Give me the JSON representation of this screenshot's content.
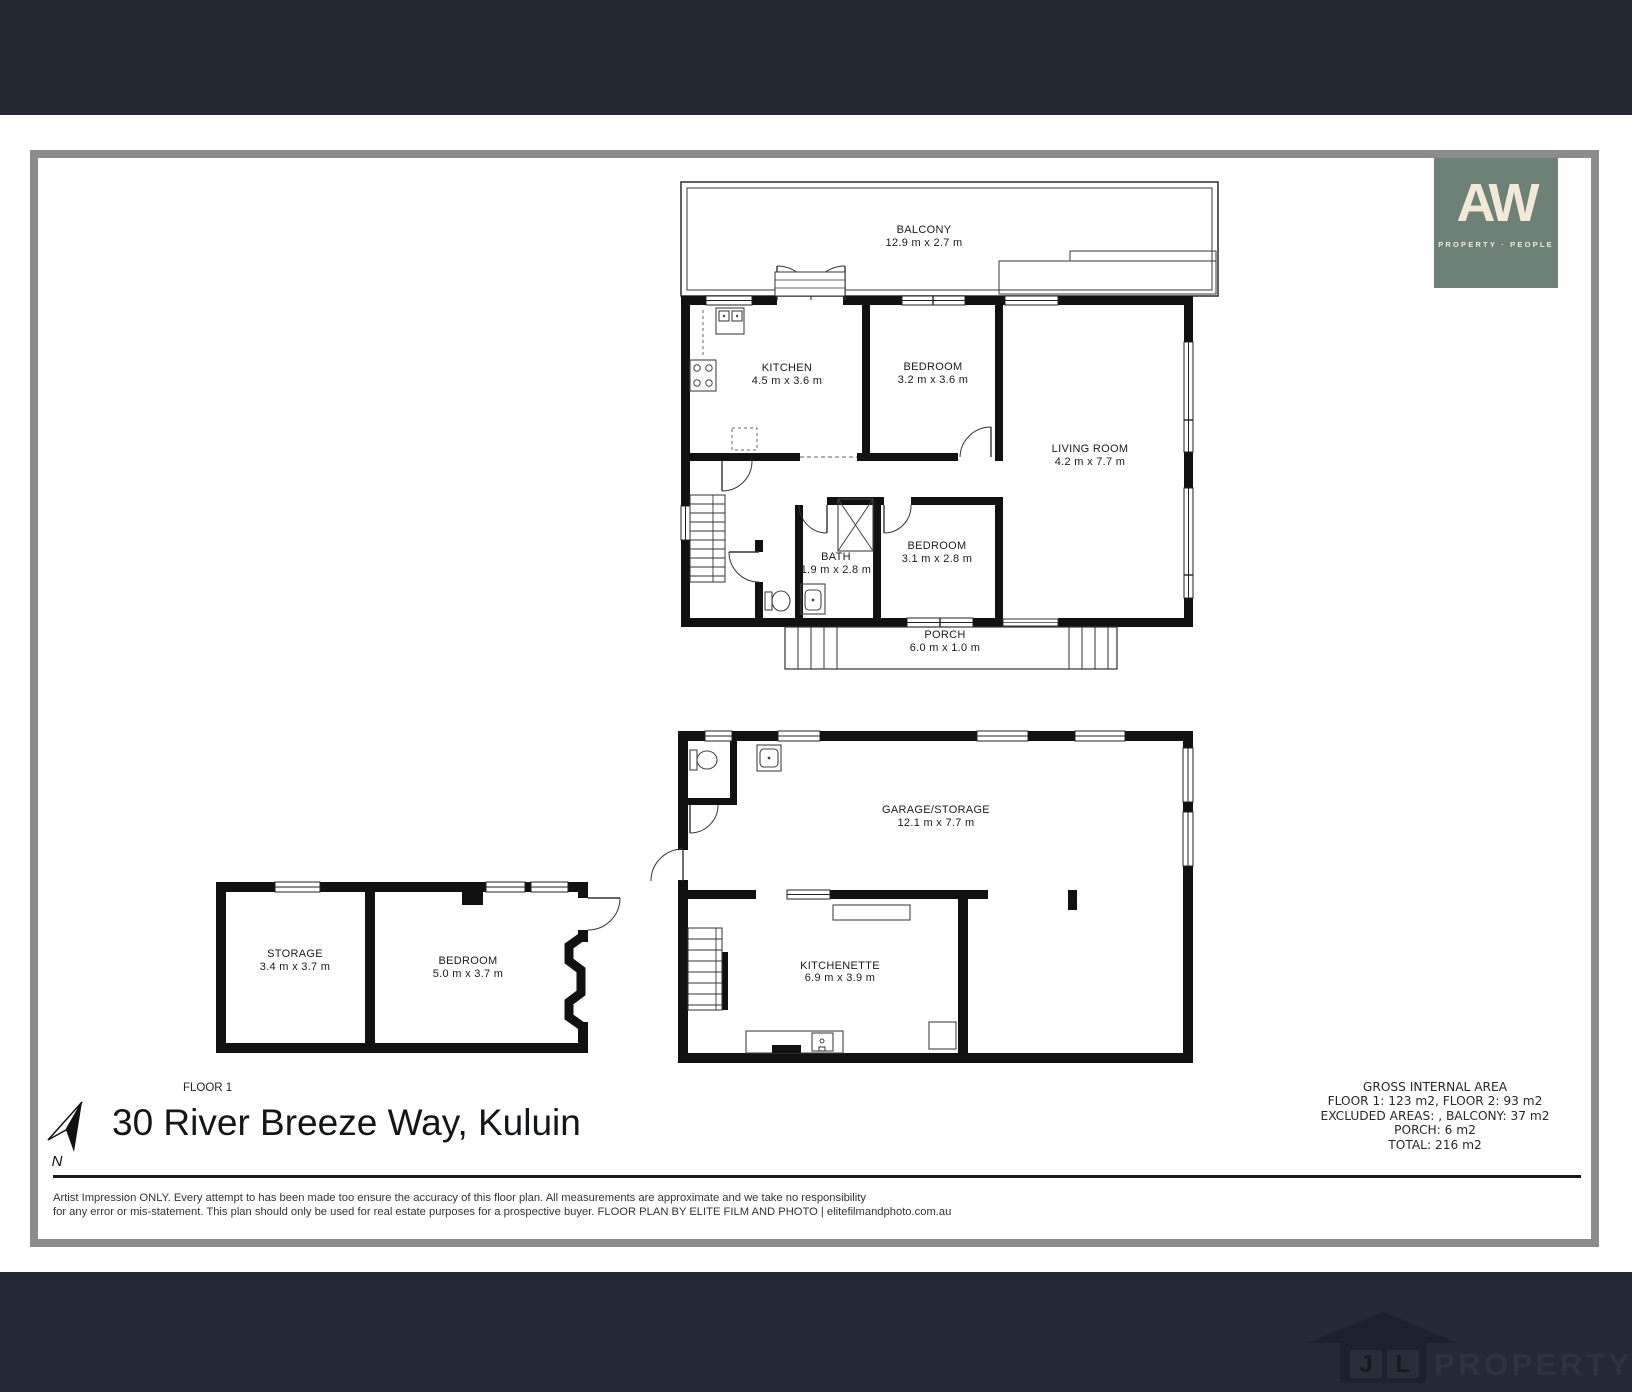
{
  "brand": {
    "monogram": "AW",
    "tagline": "PROPERTY · PEOPLE"
  },
  "floor2": {
    "balcony": {
      "name": "BALCONY",
      "dims": "12.9 m x 2.7 m"
    },
    "kitchen": {
      "name": "KITCHEN",
      "dims": "4.5 m x 3.6 m"
    },
    "bedroom1": {
      "name": "BEDROOM",
      "dims": "3.2 m x 3.6 m"
    },
    "living_room": {
      "name": "LIVING ROOM",
      "dims": "4.2 m x 7.7 m"
    },
    "bath": {
      "name": "BATH",
      "dims": "1.9 m x 2.8 m"
    },
    "bedroom2": {
      "name": "BEDROOM",
      "dims": "3.1 m x 2.8 m"
    },
    "porch": {
      "name": "PORCH",
      "dims": "6.0 m x 1.0 m"
    }
  },
  "floor1": {
    "label": "FLOOR 1",
    "storage": {
      "name": "STORAGE",
      "dims": "3.4 m x 3.7 m"
    },
    "bedroom": {
      "name": "BEDROOM",
      "dims": "5.0 m x 3.7 m"
    },
    "garage": {
      "name": "GARAGE/STORAGE",
      "dims": "12.1 m x 7.7 m"
    },
    "kitchenette": {
      "name": "KITCHENETTE",
      "dims": "6.9 m x 3.9 m"
    }
  },
  "compass": {
    "north_label": "N"
  },
  "address": "30 River Breeze Way, Kuluin",
  "area_summary": {
    "title": "GROSS INTERNAL AREA",
    "floors": "FLOOR 1: 123 m2, FLOOR 2: 93 m2",
    "excluded": "EXCLUDED AREAS: , BALCONY: 37 m2",
    "porch": "PORCH: 6 m2",
    "total": "TOTAL: 216 m2"
  },
  "disclaimer": {
    "line1": "Artist Impression ONLY. Every attempt to has been made too ensure the accuracy of this floor plan. All measurements are approximate and we take no responsibility",
    "line2": "for any error or mis-statement. This plan should only be used for real estate purposes for a prospective buyer. FLOOR PLAN BY ELITE FILM AND PHOTO | elitefilmandphoto.com.au"
  },
  "footer_brand": {
    "letters": [
      "J",
      "L"
    ],
    "wordmark": "PROPERTY"
  },
  "colors": {
    "top_bar": "#232831",
    "bottom_bar": "#232a33",
    "page_border": "#8c8c8c",
    "aw_logo_bg": "#6e8177",
    "aw_logo_text": "#f2e9d8",
    "walls": "#111111"
  }
}
